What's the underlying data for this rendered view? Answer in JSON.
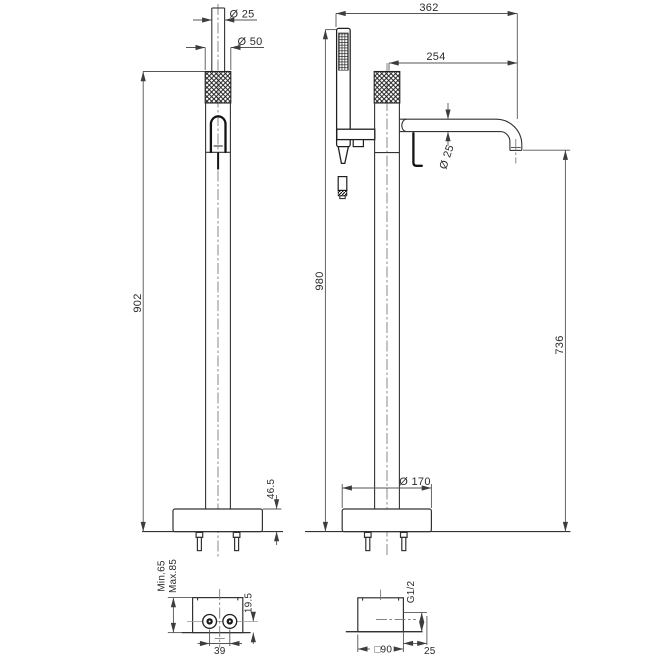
{
  "meta": {
    "background": "#ffffff",
    "object_line_color": "#333333",
    "dimension_line_color": "#555555",
    "text_color": "#2b2b2b"
  },
  "front_view": {
    "handshower_diameter": "Ø 25",
    "handle_diameter": "Ø 50",
    "height_to_handle_top": "902",
    "base_height": "46.5"
  },
  "side_view": {
    "overall_depth": "362",
    "spout_reach": "254",
    "spout_diameter": "Ø 25",
    "overall_height": "980",
    "spout_outlet_height": "736",
    "base_diameter": "Ø 170"
  },
  "rough_in_front": {
    "min_depth": "Min.65",
    "max_depth": "Max.85",
    "outlet_height": "19.5",
    "outlet_spacing": "39"
  },
  "rough_in_side": {
    "connection_thread": "G1/2",
    "body_width": "□90",
    "outlet_offset": "25"
  }
}
